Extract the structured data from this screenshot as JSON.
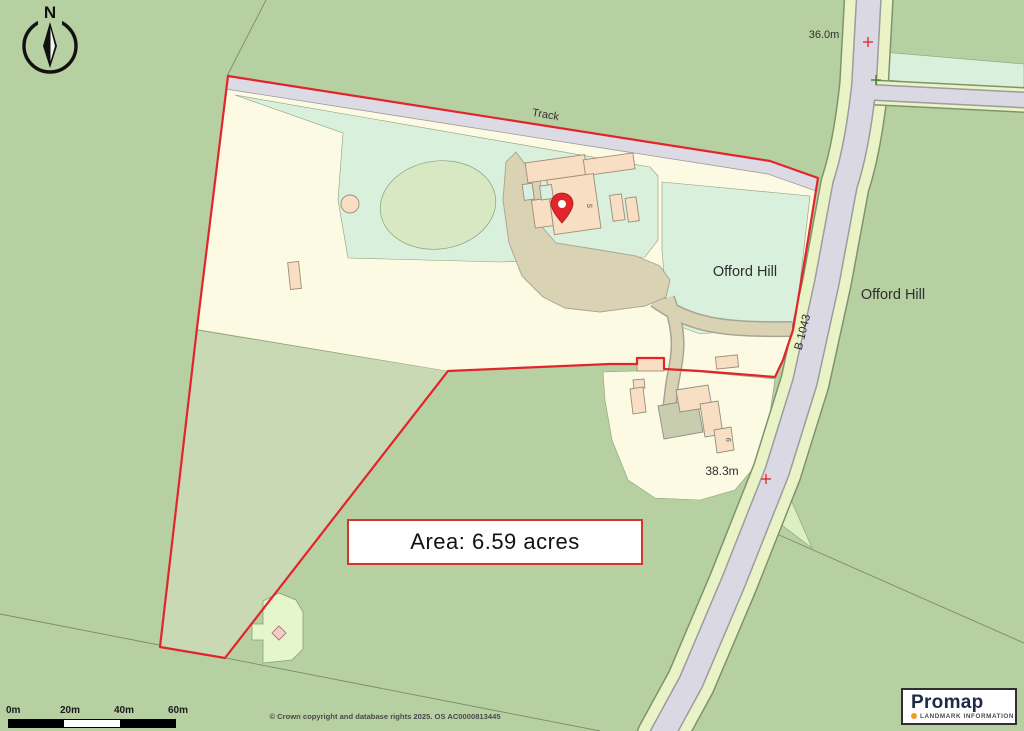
{
  "map": {
    "labels": {
      "track": "Track",
      "offord_hill_field": "Offord Hill",
      "offord_hill_area": "Offord Hill",
      "road_name": "B 1043",
      "spot_height_top": "36.0m",
      "spot_height_lower": "38.3m",
      "building_number_5": "5",
      "building_number_6": "6"
    },
    "area_box": {
      "text": "Area: 6.59 acres"
    },
    "compass": {
      "north": "N"
    },
    "scale_bar": {
      "ticks": [
        "0m",
        "20m",
        "40m",
        "60m"
      ]
    },
    "copyright": "© Crown copyright and database rights 2025. OS AC0000813445",
    "logo": {
      "brand": "Promap",
      "tagline": "LANDMARK INFORMATION"
    },
    "colors": {
      "boundary_red": "#e3242b",
      "field_green": "#b6d0a2",
      "field_sage": "#c8d9b3",
      "field_cream": "#fdfae4",
      "field_mint": "#d9f0dc",
      "road_grey": "#dad8e2",
      "verge_green": "#e9f3c6",
      "driveway_tan": "#d9d3b4",
      "building_peach": "#f8dfc3",
      "logo_orange": "#f59b22"
    }
  }
}
